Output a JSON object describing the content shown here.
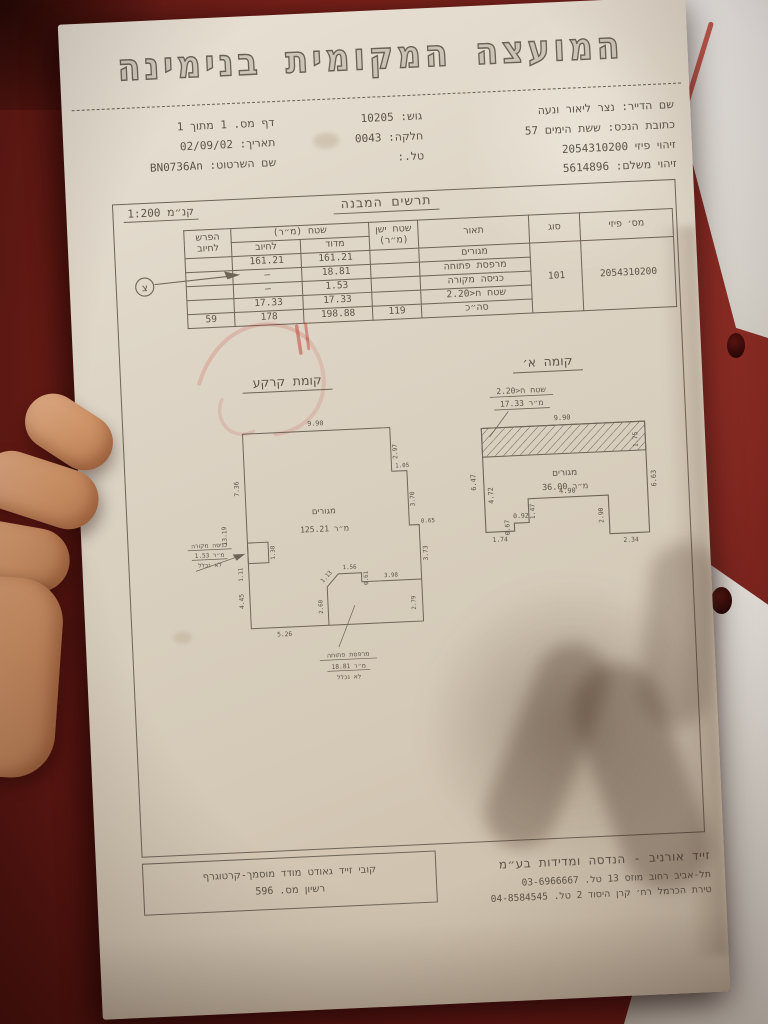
{
  "colors": {
    "leather_background": "#7c231c",
    "paper": "#d9cfc0",
    "ink": "#5d5448",
    "stamp_red": "#c03a2c",
    "skin": "#d6a07c"
  },
  "document": {
    "council_title": "המועצה המקומית בנימינה",
    "info_right": [
      "שם הדייר: נצר ליאור ונעה",
      "כתובת הנכס: ששת הימים 57",
      "זיהוי פיזי 2054310200",
      "זיהוי משלם: 5614896"
    ],
    "info_middle": [
      "גוש: 10205",
      "חלקה: 0043",
      "טל.:"
    ],
    "info_left": [
      "דף מס. 1 מתוך 1",
      "תאריך: 02/09/02",
      "שם השרטוט: BN0736An"
    ],
    "sheet_title": "תרשים המבנה",
    "scale_label": "קנ״מ 1:200",
    "north_symbol": "צ"
  },
  "table": {
    "col_physical_id": "מס׳ פיזי",
    "col_type": "סוג",
    "col_description": "תאור",
    "col_old_area": "שטח ישן (מ״ר)",
    "col_area": "שטח (מ״ר)",
    "col_measured": "מדוד",
    "col_billed": "לחיוב",
    "col_difference": "הפרש לחיוב",
    "physical_id": "2054310200",
    "type_code": "101",
    "rows": [
      {
        "description": "מגורים",
        "old_area": "",
        "measured": "161.21",
        "billed": "161.21",
        "difference": ""
      },
      {
        "description": "מרפסת פתוחה",
        "old_area": "",
        "measured": "18.81",
        "billed": "–",
        "difference": ""
      },
      {
        "description": "כניסה מקורה",
        "old_area": "",
        "measured": "1.53",
        "billed": "–",
        "difference": ""
      },
      {
        "description": "שטח ח<2.20",
        "old_area": "",
        "measured": "17.33",
        "billed": "17.33",
        "difference": ""
      }
    ],
    "total": {
      "description": "סה״כ",
      "old_area": "119",
      "measured": "198.88",
      "billed": "178",
      "difference": "59"
    }
  },
  "floor_a": {
    "title": "קומה א׳",
    "callout_1": "שטח ח<2.20",
    "callout_2": "17.33 מ״ר",
    "room_1": "מגורים",
    "room_2": "36.00 מ״ר",
    "dims": {
      "top": "9.90",
      "strip": "1.75",
      "left": "6.47",
      "left_inner": "4.72",
      "right": "6.63",
      "b1": "1.74",
      "b2": "0.67",
      "b3": "0.92",
      "b4": "1.47",
      "b5": "4.90",
      "b6": "2.90",
      "b7": "2.34"
    }
  },
  "ground_floor": {
    "title": "קומת קרקע",
    "room_1": "מגורים",
    "room_2": "125.21 מ״ר",
    "entrance_1": "כניסה מקורה",
    "entrance_2": "1.53 מ״ר",
    "entrance_3": "לא נכלל",
    "balcony_1": "מרפסת פתוחה",
    "balcony_2": "18.81 מ״ר",
    "balcony_3": "לא נכלל",
    "dims": {
      "top": "9.90",
      "left_upper": "7.36",
      "left_total": "13.19",
      "right_1": "2.97",
      "step_1": "1.05",
      "right_2": "3.70",
      "step_2": "0.65",
      "right_3": "3.73",
      "balcony_right": "2.79",
      "int_bottom": "3.98",
      "int_step": "0.61",
      "int_top": "1.56",
      "int_diag": "1.13",
      "int_left": "2.60",
      "bottom": "5.26",
      "porch_w": "1.38",
      "porch_h": "1.11",
      "left_lower": "4.45"
    }
  },
  "footer": {
    "surveyor_line1": "קובי זייד גאודט מודד מוסמך-קרטוגרף",
    "surveyor_line2": "רשיון מס. 596",
    "company_name": "זייד אורניב - הנדסה ומדידות בע״מ",
    "address_1": "תל-אביב רחוב מוזס 13 טל. 03-6966667",
    "address_2": "טירת הכרמל רח׳ קרן היסוד 2 טל. 04-8584545"
  }
}
